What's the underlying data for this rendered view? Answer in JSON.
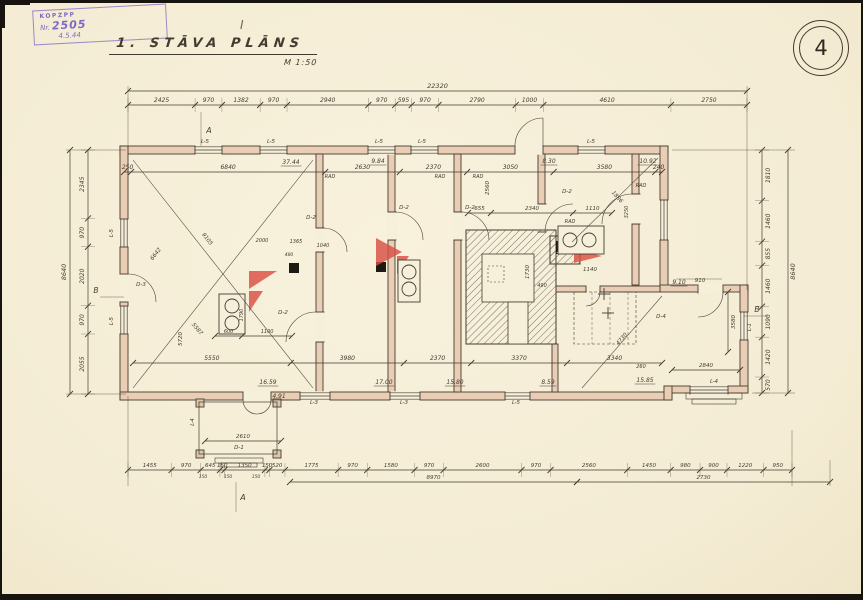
{
  "sheet": {
    "number": "4",
    "title": "1. STĀVA PLĀNS",
    "scale_label": "M 1:50"
  },
  "stamp": {
    "line1": "KOPZPP",
    "nr_prefix": "Nr.",
    "nr_number": "2505",
    "line3": "4.5.44",
    "pencil_mark": "I"
  },
  "colors": {
    "paper": "#f6efda",
    "ink": "#453c31",
    "wall": "#e9cdb4",
    "red": "#d94f43",
    "purple": "#6d58c0"
  },
  "dim_rows": [
    {
      "o": "h",
      "pos": 91,
      "from": 128,
      "to": 747,
      "segs": [
        "22320"
      ],
      "loff": -3,
      "fs": 6.5
    },
    {
      "o": "h",
      "pos": 105,
      "from": 128,
      "to": 747,
      "segs": [
        "2425",
        "970",
        "1382",
        "970",
        "2940",
        "970",
        "595",
        "970",
        "2790",
        "1000",
        "4610",
        "2750"
      ],
      "loff": -3,
      "ext": true
    },
    {
      "o": "h",
      "pos": 172,
      "from": 124,
      "to": 662,
      "segs": [
        "250",
        "6840",
        "2630",
        "2370",
        "3050",
        "3580",
        "240"
      ],
      "loff": -3
    },
    {
      "o": "h",
      "pos": 213,
      "from": 468,
      "to": 612,
      "segs": [
        "655",
        "2340",
        "1110"
      ],
      "loff": -3,
      "fs": 5.5
    },
    {
      "o": "h",
      "pos": 336,
      "from": 215,
      "to": 292,
      "segs": [
        "600",
        "1100"
      ],
      "loff": -3,
      "fs": 5
    },
    {
      "o": "h",
      "pos": 363,
      "from": 133,
      "to": 662,
      "segs": [
        "5550",
        "3980",
        "2370",
        "3370",
        "3340"
      ],
      "loff": -3
    },
    {
      "o": "h",
      "pos": 441,
      "from": 205,
      "to": 281,
      "segs": [
        "2610"
      ],
      "loff": -3,
      "fs": 5.5
    },
    {
      "o": "h",
      "pos": 370,
      "from": 672,
      "to": 740,
      "segs": [
        "2840"
      ],
      "loff": -3,
      "fs": 5.5
    },
    {
      "o": "h",
      "pos": 470,
      "from": 128,
      "to": 792,
      "segs": [
        "1455",
        "970",
        "645",
        "150",
        "1350",
        "150",
        "520",
        "1775",
        "970",
        "1580",
        "970",
        "2600",
        "970",
        "2560",
        "1450",
        "980",
        "900",
        "1220",
        "950"
      ],
      "loff": -3,
      "ext": true,
      "fs": 5.5
    },
    {
      "o": "h",
      "pos": 482,
      "from": 290,
      "to": 577,
      "segs": [
        "8970"
      ],
      "loff": -3,
      "fs": 5.5
    },
    {
      "o": "h",
      "pos": 482,
      "from": 577,
      "to": 830,
      "segs": [
        "2730"
      ],
      "loff": -3,
      "fs": 5.5
    },
    {
      "o": "v",
      "pos": 70,
      "from": 150,
      "to": 394,
      "segs": [
        "8640"
      ],
      "loff": -4,
      "fs": 6.5
    },
    {
      "o": "v",
      "pos": 88,
      "from": 150,
      "to": 394,
      "segs": [
        "2345",
        "970",
        "2020",
        "970",
        "2055"
      ],
      "loff": -4,
      "ext": true
    },
    {
      "o": "v",
      "pos": 762,
      "from": 150,
      "to": 393,
      "segs": [
        "1810",
        "1460",
        "855",
        "1460",
        "1090",
        "1420",
        "570"
      ],
      "loff": 8,
      "ext": true
    },
    {
      "o": "v",
      "pos": 788,
      "from": 150,
      "to": 393,
      "segs": [
        "8640"
      ],
      "loff": 7,
      "fs": 6.5
    },
    {
      "o": "v",
      "pos": 728,
      "from": 292,
      "to": 352,
      "segs": [
        "3580"
      ],
      "loff": 7,
      "fs": 5.5
    }
  ],
  "plan_labels": [
    {
      "t": "37.44",
      "x": 291,
      "y": 164,
      "u": 1
    },
    {
      "t": "9.84",
      "x": 378,
      "y": 163,
      "u": 1
    },
    {
      "t": "8.30",
      "x": 549,
      "y": 163,
      "u": 1
    },
    {
      "t": "10.92",
      "x": 648,
      "y": 163,
      "u": 1
    },
    {
      "t": "16.59",
      "x": 268,
      "y": 384,
      "u": 1
    },
    {
      "t": "17.00",
      "x": 384,
      "y": 384,
      "u": 1
    },
    {
      "t": "15.80",
      "x": 455,
      "y": 384,
      "u": 1
    },
    {
      "t": "8.59",
      "x": 548,
      "y": 384,
      "u": 1
    },
    {
      "t": "15.85",
      "x": 645,
      "y": 382,
      "u": 1
    },
    {
      "t": "9.10",
      "x": 679,
      "y": 284,
      "u": 1
    },
    {
      "t": "4.91",
      "x": 279,
      "y": 398,
      "u": 1
    },
    {
      "t": "RAD",
      "x": 330,
      "y": 178,
      "s": 5
    },
    {
      "t": "RAD",
      "x": 440,
      "y": 178,
      "s": 5
    },
    {
      "t": "RAD",
      "x": 478,
      "y": 178,
      "s": 5
    },
    {
      "t": "RAD",
      "x": 570,
      "y": 223,
      "s": 5
    },
    {
      "t": "RAD",
      "x": 641,
      "y": 187,
      "s": 5
    },
    {
      "t": "L-5",
      "x": 205,
      "y": 143,
      "s": 5.5
    },
    {
      "t": "L-5",
      "x": 271,
      "y": 143,
      "s": 5.5
    },
    {
      "t": "L-5",
      "x": 379,
      "y": 143,
      "s": 5.5
    },
    {
      "t": "L-5",
      "x": 422,
      "y": 143,
      "s": 5.5
    },
    {
      "t": "L-5",
      "x": 591,
      "y": 143,
      "s": 5.5
    },
    {
      "t": "L-3",
      "x": 314,
      "y": 404,
      "s": 5.5
    },
    {
      "t": "L-3",
      "x": 404,
      "y": 404,
      "s": 5.5
    },
    {
      "t": "L-5",
      "x": 516,
      "y": 404,
      "s": 5.5
    },
    {
      "t": "L-5",
      "x": 113,
      "y": 233,
      "r": -90,
      "s": 5.5
    },
    {
      "t": "L-5",
      "x": 113,
      "y": 321,
      "r": -90,
      "s": 5.5
    },
    {
      "t": "L-1",
      "x": 751,
      "y": 327,
      "r": -90,
      "s": 5.5
    },
    {
      "t": "L-4",
      "x": 714,
      "y": 383,
      "s": 5.5
    },
    {
      "t": "L-4",
      "x": 194,
      "y": 422,
      "r": -90,
      "s": 5
    },
    {
      "t": "D-2",
      "x": 404,
      "y": 209,
      "s": 5.5
    },
    {
      "t": "D-2",
      "x": 470,
      "y": 209,
      "s": 5.5
    },
    {
      "t": "D-2",
      "x": 567,
      "y": 193,
      "s": 5.5
    },
    {
      "t": "D-2",
      "x": 311,
      "y": 219,
      "s": 5.5
    },
    {
      "t": "D-2",
      "x": 283,
      "y": 314,
      "s": 5.5
    },
    {
      "t": "D-3",
      "x": 141,
      "y": 286,
      "s": 5.5
    },
    {
      "t": "D-1",
      "x": 239,
      "y": 449,
      "s": 5.5
    },
    {
      "t": "D-4",
      "x": 661,
      "y": 318,
      "s": 5.5
    },
    {
      "t": "2560",
      "x": 489,
      "y": 188,
      "r": -90,
      "s": 5.5
    },
    {
      "t": "1730",
      "x": 529,
      "y": 272,
      "r": -90,
      "s": 5.5
    },
    {
      "t": "490",
      "x": 542,
      "y": 287,
      "s": 5
    },
    {
      "t": "1140",
      "x": 590,
      "y": 271,
      "s": 5.5
    },
    {
      "t": "910",
      "x": 700,
      "y": 282,
      "s": 5.5
    },
    {
      "t": "5720",
      "x": 182,
      "y": 339,
      "r": -90,
      "s": 5.5
    },
    {
      "t": "1790",
      "x": 243,
      "y": 315,
      "r": -90,
      "s": 5
    },
    {
      "t": "1886",
      "x": 616,
      "y": 198,
      "r": 48,
      "s": 5.5
    },
    {
      "t": "3250",
      "x": 628,
      "y": 212,
      "r": -90,
      "s": 5
    },
    {
      "t": "4730",
      "x": 623,
      "y": 340,
      "r": -49,
      "s": 5.5
    },
    {
      "t": "5587",
      "x": 196,
      "y": 330,
      "r": 50,
      "s": 5.5
    },
    {
      "t": "9105",
      "x": 206,
      "y": 240,
      "r": 52,
      "s": 5.5
    },
    {
      "t": "6642",
      "x": 157,
      "y": 255,
      "r": -52,
      "s": 5.5
    },
    {
      "t": "1365",
      "x": 296,
      "y": 243,
      "s": 5
    },
    {
      "t": "2000",
      "x": 262,
      "y": 242,
      "s": 5
    },
    {
      "t": "1040",
      "x": 323,
      "y": 247,
      "s": 5
    },
    {
      "t": "480",
      "x": 289,
      "y": 256,
      "s": 4.5
    },
    {
      "t": "260",
      "x": 641,
      "y": 368,
      "s": 5
    },
    {
      "t": "150",
      "x": 203,
      "y": 478,
      "s": 4.5
    },
    {
      "t": "150",
      "x": 228,
      "y": 478,
      "s": 4.5
    },
    {
      "t": "150",
      "x": 256,
      "y": 478,
      "s": 4.5
    },
    {
      "t": "A",
      "x": 209,
      "y": 133,
      "s": 8
    },
    {
      "t": "A",
      "x": 243,
      "y": 500,
      "s": 8
    },
    {
      "t": "B",
      "x": 96,
      "y": 293,
      "s": 7.5
    },
    {
      "t": "B",
      "x": 757,
      "y": 312,
      "s": 7.5
    }
  ]
}
